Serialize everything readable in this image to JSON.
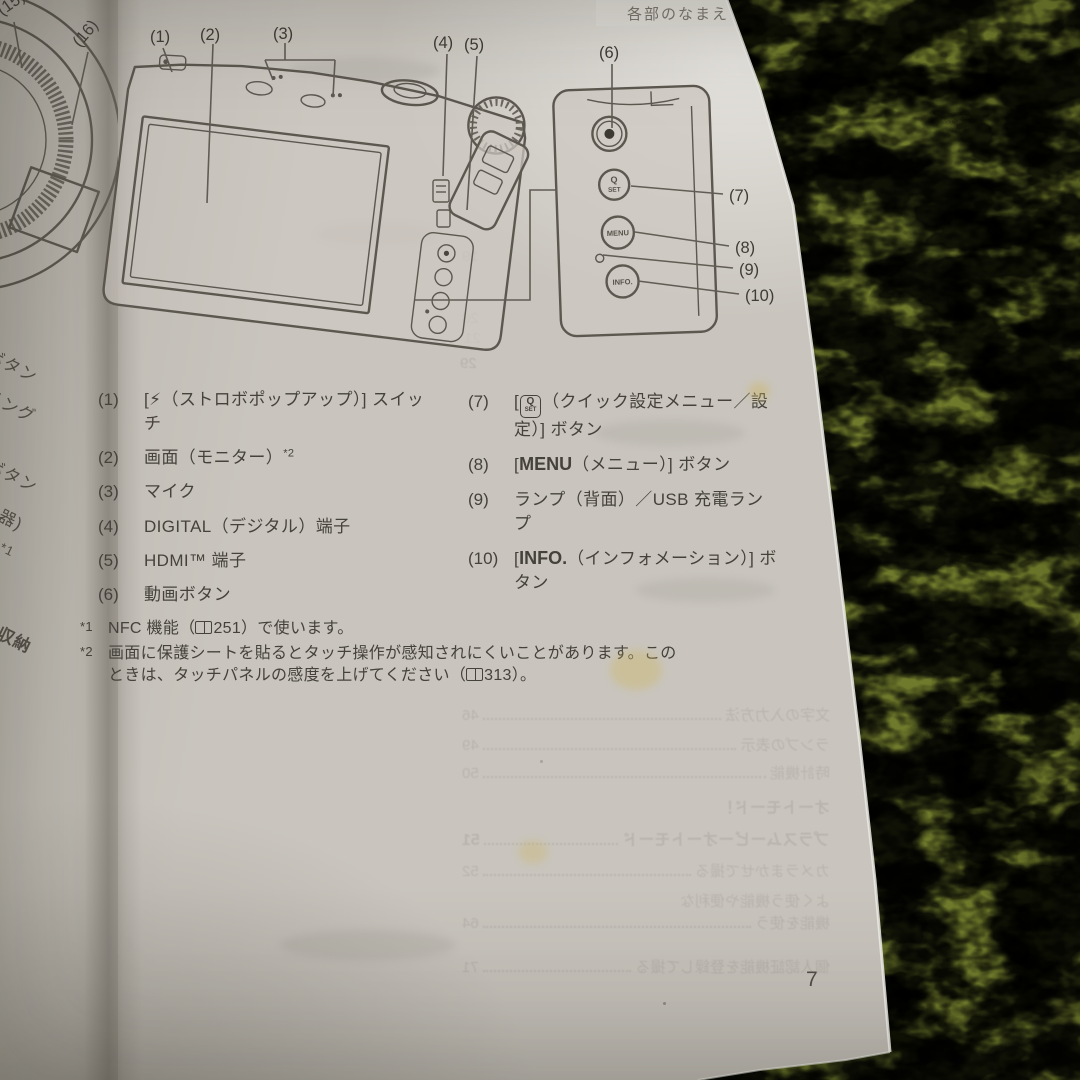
{
  "page": {
    "header": "各部のなまえ",
    "page_number": "7"
  },
  "diagram": {
    "callouts": {
      "c1": "(1)",
      "c2": "(2)",
      "c3": "(3)",
      "c4": "(4)",
      "c5": "(5)",
      "c6": "(6)",
      "c7": "(7)",
      "c8": "(8)",
      "c9": "(9)",
      "c10": "(10)"
    },
    "panel": {
      "q": "Q",
      "set": "SET",
      "menu": "MENU",
      "info": "INFO."
    }
  },
  "left_page": {
    "c15": "(15)",
    "c16": "(16)",
    "fragments": [
      "ボタン",
      "リング",
      "ボタン",
      "機器)",
      "*1",
      "ー収納"
    ]
  },
  "parts": {
    "left": [
      {
        "num": "(1)",
        "text": "[⚡（ストロボポップアップ）] スイッチ"
      },
      {
        "num": "(2)",
        "text": "画面（モニター）",
        "sup": "*2"
      },
      {
        "num": "(3)",
        "text": "マイク"
      },
      {
        "num": "(4)",
        "text": "DIGITAL（デジタル）端子"
      },
      {
        "num": "(5)",
        "text": "HDMI™ 端子"
      },
      {
        "num": "(6)",
        "text": "動画ボタン"
      }
    ],
    "right": [
      {
        "num": "(7)",
        "open": "[",
        "icon_top": "Q",
        "icon_bottom": "SET",
        "rest": "（クイック設定メニュー／設定）] ボタン"
      },
      {
        "num": "(8)",
        "open": "[",
        "strong": "MENU",
        "rest": "（メニュー）] ボタン"
      },
      {
        "num": "(9)",
        "text": "ランプ（背面）／USB 充電ランプ"
      },
      {
        "num": "(10)",
        "open": "[",
        "strong": "INFO.",
        "rest": "（インフォメーション）] ボタン"
      }
    ]
  },
  "footnotes": [
    {
      "marker": "*1",
      "a": "NFC 機能（",
      "ref": "251",
      "b": "）で使います。"
    },
    {
      "marker": "*2",
      "a": "画面に保護シートを貼るとタッチ操作が感知されにくいことがあります。このときは、タッチパネルの感度を上げてください（",
      "ref": "313",
      "b": "）。"
    }
  ],
  "bleedthrough": {
    "toc": [
      {
        "t": "文字の入力方法",
        "n": "46"
      },
      {
        "t": "ランプの表示",
        "n": "49"
      },
      {
        "t": "時計機能",
        "n": "50"
      },
      {
        "t": "オートモード！",
        "n": ""
      },
      {
        "t": "プラスムービーオートモード",
        "n": "51"
      },
      {
        "t": "カメラまかせで撮る",
        "n": "52"
      },
      {
        "t": "よく使う機能や便利な",
        "n": ""
      },
      {
        "t": "機能を使う",
        "n": "64"
      },
      {
        "t": "個人認証機能を登録して撮る",
        "n": "71"
      }
    ],
    "nums": [
      "19",
      "20",
      "21",
      "29"
    ]
  }
}
